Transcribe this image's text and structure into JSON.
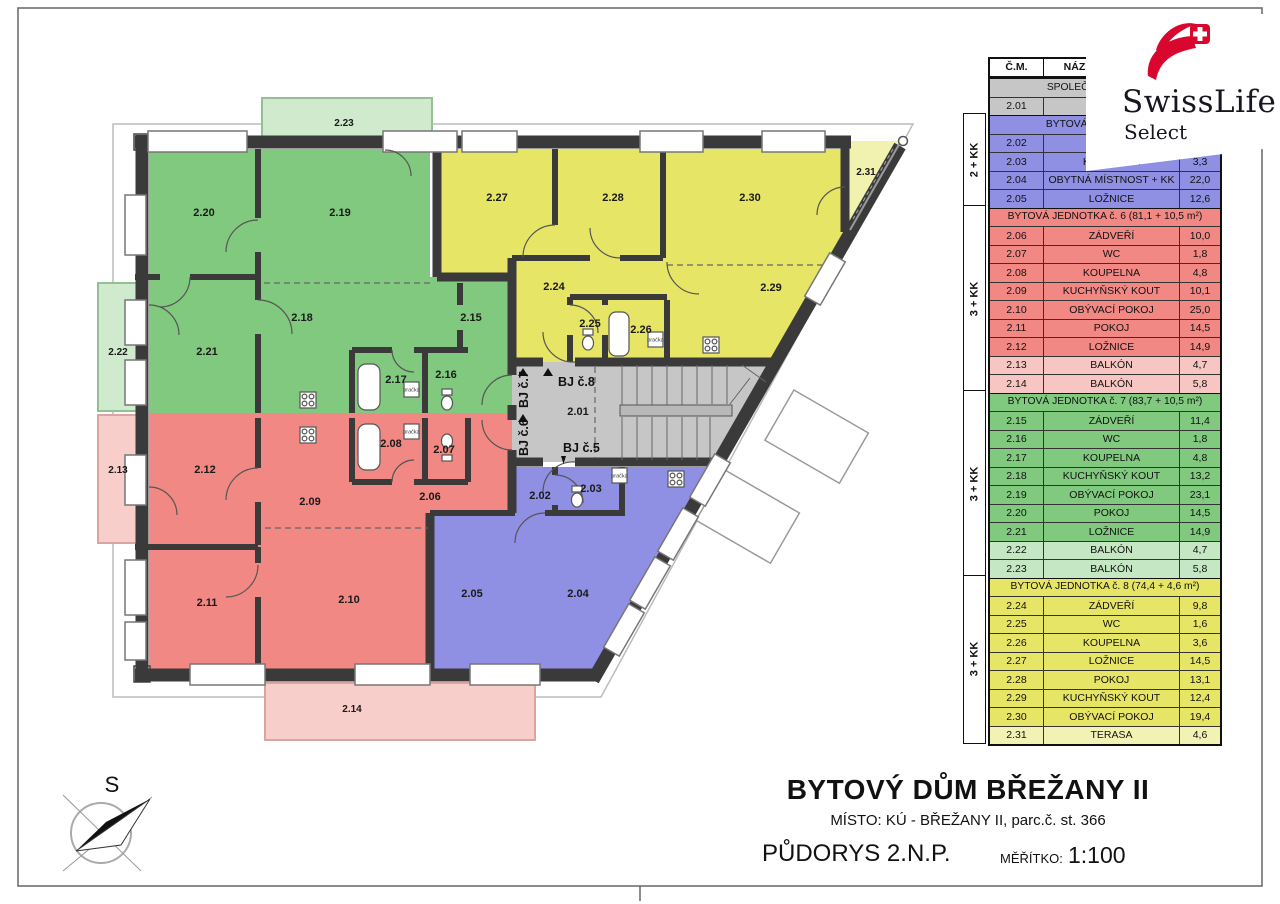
{
  "page": {
    "title": "BYTOVÝ DŮM BŘEŽANY II",
    "subtitle": "MÍSTO: KÚ - BŘEŽANY II, parc.č. st. 366",
    "drawing_name": "PŮDORYS 2.N.P.",
    "scale_label": "MĚŘÍTKO:",
    "scale_value": "1:100"
  },
  "logo": {
    "brand": "SwissLife",
    "sub": "Select"
  },
  "legend": {
    "headers": {
      "code": "Č.M.",
      "name": "NÁZEV MÍSTNOSTI",
      "area": ""
    },
    "sections": [
      {
        "label": "SPOLEČNÉ PROSTORY",
        "type_label": "",
        "color": "gray",
        "color_hex": "#c6c6c6",
        "rows": [
          {
            "code": "2.01",
            "name": "CHODBA",
            "area": ""
          }
        ]
      },
      {
        "label": "BYTOVÁ JEDNOTKA č. 5",
        "type_label": "2 + KK",
        "color": "blue",
        "color_hex": "#8f8fe3",
        "rows": [
          {
            "code": "2.02",
            "name": "ZÁDVEŘÍ",
            "area": ""
          },
          {
            "code": "2.03",
            "name": "KOUPELNA",
            "area": "3,3"
          },
          {
            "code": "2.04",
            "name": "OBYTNÁ MÍSTNOST + KK",
            "area": "22,0"
          },
          {
            "code": "2.05",
            "name": "LOŽNICE",
            "area": "12,6"
          }
        ]
      },
      {
        "label": "BYTOVÁ JEDNOTKA č. 6 (81,1 + 10,5 m²)",
        "type_label": "3 + KK",
        "color": "red",
        "color_hex": "#f28884",
        "rows": [
          {
            "code": "2.06",
            "name": "ZÁDVEŘÍ",
            "area": "10,0"
          },
          {
            "code": "2.07",
            "name": "WC",
            "area": "1,8"
          },
          {
            "code": "2.08",
            "name": "KOUPELNA",
            "area": "4,8"
          },
          {
            "code": "2.09",
            "name": "KUCHYŇSKÝ KOUT",
            "area": "10,1"
          },
          {
            "code": "2.10",
            "name": "OBÝVACÍ POKOJ",
            "area": "25,0"
          },
          {
            "code": "2.11",
            "name": "POKOJ",
            "area": "14,5"
          },
          {
            "code": "2.12",
            "name": "LOŽNICE",
            "area": "14,9"
          },
          {
            "code": "2.13",
            "name": "BALKÓN",
            "area": "4,7",
            "light": true
          },
          {
            "code": "2.14",
            "name": "BALKÓN",
            "area": "5,8",
            "light": true
          }
        ]
      },
      {
        "label": "BYTOVÁ JEDNOTKA č. 7 (83,7 + 10,5 m²)",
        "type_label": "3 + KK",
        "color": "green",
        "color_hex": "#80c97f",
        "rows": [
          {
            "code": "2.15",
            "name": "ZÁDVEŘÍ",
            "area": "11,4"
          },
          {
            "code": "2.16",
            "name": "WC",
            "area": "1,8"
          },
          {
            "code": "2.17",
            "name": "KOUPELNA",
            "area": "4,8"
          },
          {
            "code": "2.18",
            "name": "KUCHYŇSKÝ KOUT",
            "area": "13,2"
          },
          {
            "code": "2.19",
            "name": "OBÝVACÍ POKOJ",
            "area": "23,1"
          },
          {
            "code": "2.20",
            "name": "POKOJ",
            "area": "14,5"
          },
          {
            "code": "2.21",
            "name": "LOŽNICE",
            "area": "14,9"
          },
          {
            "code": "2.22",
            "name": "BALKÓN",
            "area": "4,7",
            "light": true
          },
          {
            "code": "2.23",
            "name": "BALKÓN",
            "area": "5,8",
            "light": true
          }
        ]
      },
      {
        "label": "BYTOVÁ JEDNOTKA č. 8 (74,4 + 4,6 m²)",
        "type_label": "3 + KK",
        "color": "yellow",
        "color_hex": "#e7e566",
        "rows": [
          {
            "code": "2.24",
            "name": "ZÁDVEŘÍ",
            "area": "9,8"
          },
          {
            "code": "2.25",
            "name": "WC",
            "area": "1,6"
          },
          {
            "code": "2.26",
            "name": "KOUPELNA",
            "area": "3,6"
          },
          {
            "code": "2.27",
            "name": "LOŽNICE",
            "area": "14,5"
          },
          {
            "code": "2.28",
            "name": "POKOJ",
            "area": "13,1"
          },
          {
            "code": "2.29",
            "name": "KUCHYŇSKÝ KOUT",
            "area": "12,4"
          },
          {
            "code": "2.30",
            "name": "OBÝVACÍ POKOJ",
            "area": "19,4"
          },
          {
            "code": "2.31",
            "name": "TERASA",
            "area": "4,6",
            "light": true
          }
        ]
      }
    ]
  },
  "plan": {
    "labels": {
      "r201": "2.01",
      "r202": "2.02",
      "r203": "2.03",
      "r204": "2.04",
      "r205": "2.05",
      "r206": "2.06",
      "r207": "2.07",
      "r208": "2.08",
      "r209": "2.09",
      "r210": "2.10",
      "r211": "2.11",
      "r212": "2.12",
      "r213": "2.13",
      "r214": "2.14",
      "r215": "2.15",
      "r216": "2.16",
      "r217": "2.17",
      "r218": "2.18",
      "r219": "2.19",
      "r220": "2.20",
      "r221": "2.21",
      "r222": "2.22",
      "r223": "2.23",
      "r224": "2.24",
      "r225": "2.25",
      "r226": "2.26",
      "r227": "2.27",
      "r228": "2.28",
      "r229": "2.29",
      "r230": "2.30",
      "r231": "2.31"
    },
    "entrance_labels": {
      "b5": "BJ č.5",
      "b6": "BJ č.6",
      "b7": "BJ č.7",
      "b8": "BJ č.8"
    },
    "appliance_label": "pračka",
    "compass_label": "S",
    "colors": {
      "unit5_blue": "#8f8fe3",
      "unit6_red": "#f28884",
      "unit7_green": "#80c97f",
      "unit8_yellow": "#e7e566",
      "common_gray": "#c6c6c6",
      "balcony_green": "#cfeacd",
      "balcony_red": "#f8cecb",
      "terrace_yellow": "#f2f2b0",
      "logo_red": "#d9072d"
    }
  }
}
